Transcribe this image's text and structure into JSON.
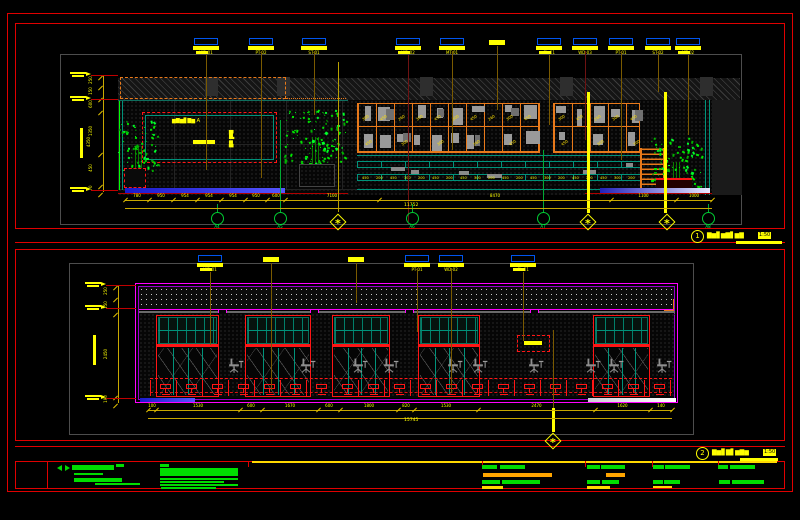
{
  "colors": {
    "red": "#e00000",
    "brightred": "#ff1515",
    "magenta": "#ff00ff",
    "purple": "#9900cc",
    "orange": "#e8791a",
    "teal": "#00927a",
    "green": "#00dd00",
    "bgreen": "#00ff00",
    "yellow": "#ffff00",
    "dimline": "#c8a800",
    "blue": "#0055ee",
    "maroon": "#6e1212",
    "olive": "#7a5a00",
    "grayb": "#4d4d4d",
    "blob": "#9a9a9a",
    "chair": "#8f8f8f",
    "redline": "#c00000"
  },
  "symbols": {
    "star": "*"
  },
  "drawing1": {
    "title": {
      "number": "1",
      "text": "▇▆▊▆▇▋▆▇",
      "scale": "1:50"
    },
    "callouts": [
      {
        "x": 206,
        "style": "tag",
        "tag": "WD-01",
        "drop": 170,
        "lc": "olive",
        "b2": true
      },
      {
        "x": 261,
        "style": "tag",
        "tag": "PT-02",
        "drop": 178,
        "lc": "olive"
      },
      {
        "x": 314,
        "style": "tag",
        "tag": "ST-01",
        "drop": 115,
        "lc": "olive"
      },
      {
        "x": 408,
        "style": "tag",
        "tag": "WD-02",
        "drop": 222,
        "lc": "maroon",
        "b2": true
      },
      {
        "x": 452,
        "style": "tag",
        "tag": "MT-01",
        "drop": 150,
        "lc": "olive"
      },
      {
        "x": 497,
        "style": "bar",
        "drop": 110,
        "lc": "olive"
      },
      {
        "x": 549,
        "style": "tag",
        "tag": "GL-01",
        "drop": 125,
        "lc": "olive",
        "b2": true
      },
      {
        "x": 585,
        "style": "tag",
        "tag": "WD-03",
        "drop": 140,
        "lc": "maroon"
      },
      {
        "x": 621,
        "style": "tag",
        "tag": "PT-01",
        "drop": 160,
        "lc": "olive"
      },
      {
        "x": 658,
        "style": "tag",
        "tag": "ST-02",
        "drop": 92,
        "lc": "olive"
      },
      {
        "x": 688,
        "style": "tag",
        "tag": "MT-02",
        "drop": 135,
        "lc": "olive",
        "b2": true
      }
    ],
    "bubbles": [
      {
        "x": 217,
        "label": "A4"
      },
      {
        "x": 280,
        "label": "A5"
      },
      {
        "x": 412,
        "label": "A6"
      },
      {
        "x": 543,
        "label": "A7"
      },
      {
        "x": 708,
        "label": "A8"
      }
    ],
    "diamonds": [
      338,
      588,
      667
    ],
    "thick": [
      {
        "x": 588,
        "y1": 92,
        "y2": 213
      },
      {
        "x": 665,
        "y1": 92,
        "y2": 213
      }
    ],
    "extra_leaders": [
      {
        "x": 338,
        "y1": 62,
        "y2": 212,
        "c": "#b8a000"
      },
      {
        "x": 543,
        "y1": 150,
        "y2": 210,
        "c": "#00aa33"
      },
      {
        "x": 280,
        "y1": 120,
        "y2": 210,
        "c": "#00aa33"
      }
    ],
    "dim_bottom": {
      "y": 200,
      "ticks": [
        125,
        149,
        173,
        197,
        221,
        245,
        267,
        285,
        379,
        611,
        676,
        712
      ],
      "labels": [
        "780",
        "950",
        "954",
        "954",
        "954",
        "950",
        "600",
        "7100",
        "8470",
        "1100",
        "1000"
      ]
    },
    "dim_total": {
      "label": "11752",
      "x": 404,
      "y": 204
    },
    "dim_left": {
      "x": 103,
      "ticks": [
        75,
        85,
        97,
        110,
        152,
        184,
        192
      ],
      "labels": [
        "250",
        "150",
        "600",
        "1350",
        "450",
        "70"
      ]
    },
    "flags": [
      75,
      99,
      190
    ],
    "vlabel": "4350",
    "ann": {
      "text": "▆▇▆▊▇▆ A",
      "vtext": "▇▆▋▆▇"
    },
    "grid_nums": [
      "300",
      "450",
      "260",
      "300",
      "450"
    ],
    "band_nums": [
      "450",
      "200",
      "450",
      "300",
      "200"
    ]
  },
  "drawing2": {
    "title": {
      "number": "2",
      "text": "▇▆▊▇▋▆▇▆",
      "scale": "1:50"
    },
    "callouts": [
      {
        "x": 210,
        "style": "tag",
        "tag": "WD-01",
        "drop": 345,
        "lc": "olive",
        "b2": true
      },
      {
        "x": 271,
        "style": "bar",
        "drop": 390,
        "lc": "olive"
      },
      {
        "x": 356,
        "style": "bar",
        "drop": 303,
        "lc": "olive"
      },
      {
        "x": 417,
        "style": "tag",
        "tag": "PT-01",
        "drop": 332,
        "lc": "olive"
      },
      {
        "x": 451,
        "style": "tag",
        "tag": "WD-02",
        "drop": 393,
        "lc": "olive"
      },
      {
        "x": 523,
        "style": "tag",
        "tag": "GL-01",
        "drop": 341,
        "lc": "olive",
        "b2": true
      }
    ],
    "dim_bottom": {
      "y": 410,
      "ticks": [
        148,
        156,
        240,
        262,
        318,
        340,
        398,
        414,
        478,
        595,
        650,
        672
      ],
      "labels": [
        "100",
        "1530",
        "600",
        "1670",
        "600",
        "1800",
        "820",
        "1530",
        "2470",
        "1620",
        "140"
      ]
    },
    "dim_total": {
      "label": "15745",
      "x": 404,
      "y": 419
    },
    "dim_left": {
      "x": 118,
      "ticks": [
        285,
        297,
        312,
        395,
        403
      ],
      "labels": [
        "250",
        "150",
        "2450",
        "190"
      ]
    },
    "flags": [
      285,
      308,
      398
    ],
    "bays": [
      {
        "x": 156,
        "w": 63
      },
      {
        "x": 245,
        "w": 66
      },
      {
        "x": 332,
        "w": 58
      },
      {
        "x": 418,
        "w": 62
      },
      {
        "x": 593,
        "w": 57
      }
    ],
    "notches": [
      218,
      310,
      405,
      530
    ],
    "chairs": [
      228,
      300,
      352,
      383,
      447,
      472,
      528,
      585,
      608,
      656
    ],
    "diamond": {
      "x": 553,
      "y": 441
    }
  },
  "titleblock": {
    "ticks": [
      47,
      248,
      482,
      585,
      652,
      718
    ],
    "bars": [
      [
        72,
        465,
        42,
        5,
        "g"
      ],
      [
        116,
        464,
        8,
        3,
        "g"
      ],
      [
        74,
        473,
        29,
        2,
        "g"
      ],
      [
        74,
        478,
        48,
        4,
        "g"
      ],
      [
        95,
        483,
        45,
        2,
        "g"
      ],
      [
        160,
        464,
        9,
        3,
        "g"
      ],
      [
        160,
        468,
        78,
        8,
        "g"
      ],
      [
        160,
        478,
        78,
        2,
        "g"
      ],
      [
        160,
        481,
        64,
        2,
        "g"
      ],
      [
        160,
        484,
        78,
        2,
        "g"
      ],
      [
        161,
        487,
        55,
        2,
        "g"
      ],
      [
        482,
        465,
        15,
        4,
        "g"
      ],
      [
        500,
        465,
        25,
        4,
        "g"
      ],
      [
        483,
        473,
        69,
        4,
        "o"
      ],
      [
        482,
        480,
        18,
        4,
        "g"
      ],
      [
        502,
        480,
        38,
        4,
        "g"
      ],
      [
        482,
        486,
        21,
        3,
        "y"
      ],
      [
        587,
        465,
        13,
        4,
        "g"
      ],
      [
        601,
        465,
        24,
        4,
        "g"
      ],
      [
        606,
        473,
        19,
        4,
        "o"
      ],
      [
        587,
        480,
        13,
        4,
        "g"
      ],
      [
        602,
        480,
        17,
        4,
        "g"
      ],
      [
        587,
        486,
        23,
        3,
        "y"
      ],
      [
        653,
        465,
        11,
        4,
        "g"
      ],
      [
        665,
        465,
        25,
        4,
        "g"
      ],
      [
        653,
        480,
        10,
        4,
        "g"
      ],
      [
        664,
        480,
        16,
        4,
        "g"
      ],
      [
        653,
        486,
        19,
        2,
        "y"
      ],
      [
        718,
        465,
        10,
        4,
        "g"
      ],
      [
        730,
        465,
        25,
        4,
        "g"
      ],
      [
        719,
        480,
        11,
        4,
        "g"
      ],
      [
        732,
        480,
        32,
        4,
        "g"
      ]
    ]
  }
}
